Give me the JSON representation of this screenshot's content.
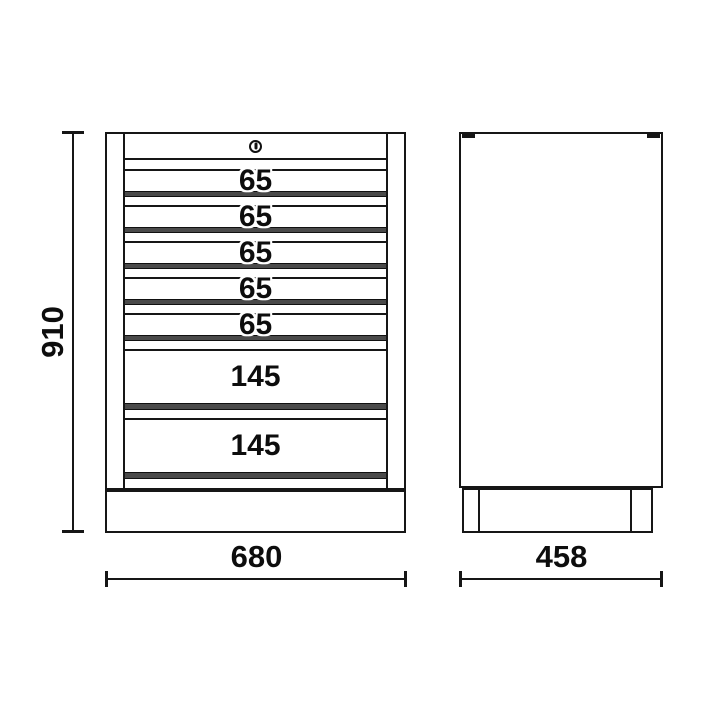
{
  "figure": {
    "type": "technical-drawing",
    "views": [
      "front",
      "side"
    ]
  },
  "front_view": {
    "drawers": [
      {
        "label": "65"
      },
      {
        "label": "65"
      },
      {
        "label": "65"
      },
      {
        "label": "65"
      },
      {
        "label": "65"
      },
      {
        "label": "145"
      },
      {
        "label": "145"
      }
    ],
    "dim_height": "910",
    "dim_width": "680"
  },
  "side_view": {
    "dim_depth": "458"
  },
  "icons": {
    "lock": "keyhole-circle"
  },
  "colors": {
    "line": "#161616",
    "handle_strip": "#4a4a4a",
    "background": "#ffffff",
    "text": "#0d0d0d"
  }
}
